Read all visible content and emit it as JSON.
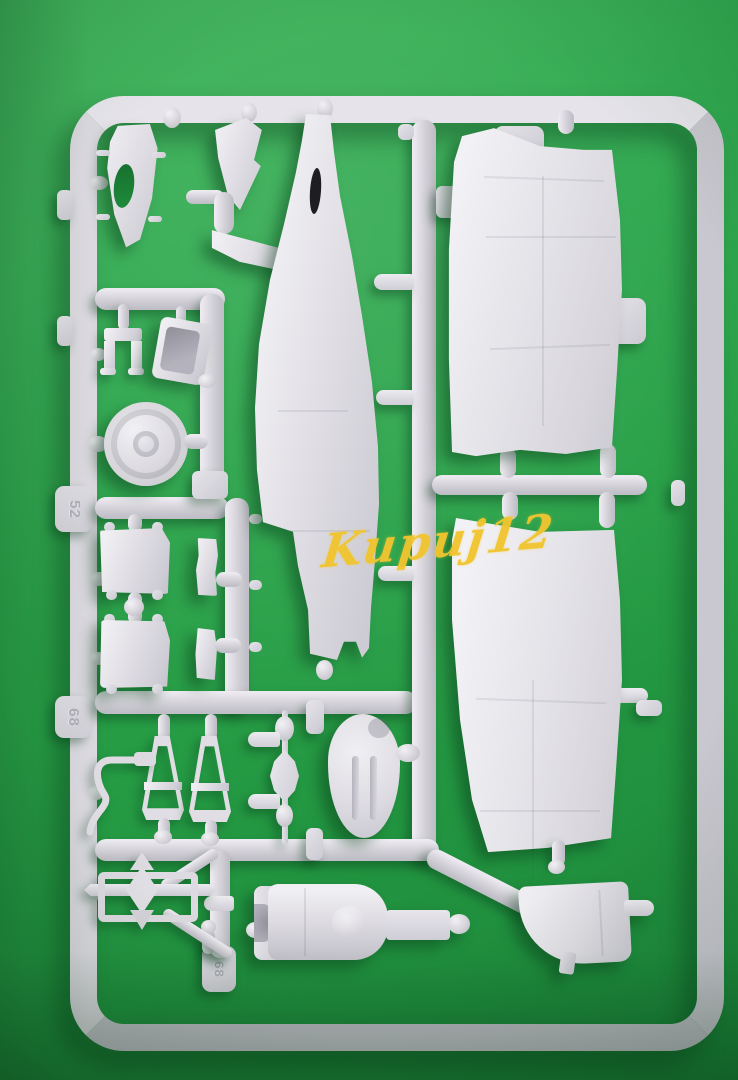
{
  "scene": {
    "description": "photo of a light-grey injection-molded model aircraft sprue lying on a bright green backdrop",
    "background_color": "#28a047",
    "plastic_color": "#dcdae0",
    "shadow_color": "#14642a"
  },
  "watermark": {
    "text": "Kupuj12",
    "color": "#f1c52f"
  },
  "sprue": {
    "embossed_numbers": {
      "upper": "52",
      "middle": "68",
      "bottom": "68"
    },
    "parts": [
      {
        "name": "nose-half"
      },
      {
        "name": "tail-fin"
      },
      {
        "name": "tailplane"
      },
      {
        "name": "fuselage-half"
      },
      {
        "name": "upper-wing-panel"
      },
      {
        "name": "lower-wing-panel"
      },
      {
        "name": "main-wheel"
      },
      {
        "name": "cockpit-bracket"
      },
      {
        "name": "seat-tray"
      },
      {
        "name": "radiator-box-1"
      },
      {
        "name": "radiator-box-2"
      },
      {
        "name": "small-strip-1"
      },
      {
        "name": "small-strip-2"
      },
      {
        "name": "exhaust-chain"
      },
      {
        "name": "oval-cover"
      },
      {
        "name": "landing-gear-strut-1"
      },
      {
        "name": "landing-gear-strut-2"
      },
      {
        "name": "antenna-wire"
      },
      {
        "name": "gear-leg-assembly"
      },
      {
        "name": "engine-cowling"
      },
      {
        "name": "wheel-bay-door"
      }
    ]
  }
}
